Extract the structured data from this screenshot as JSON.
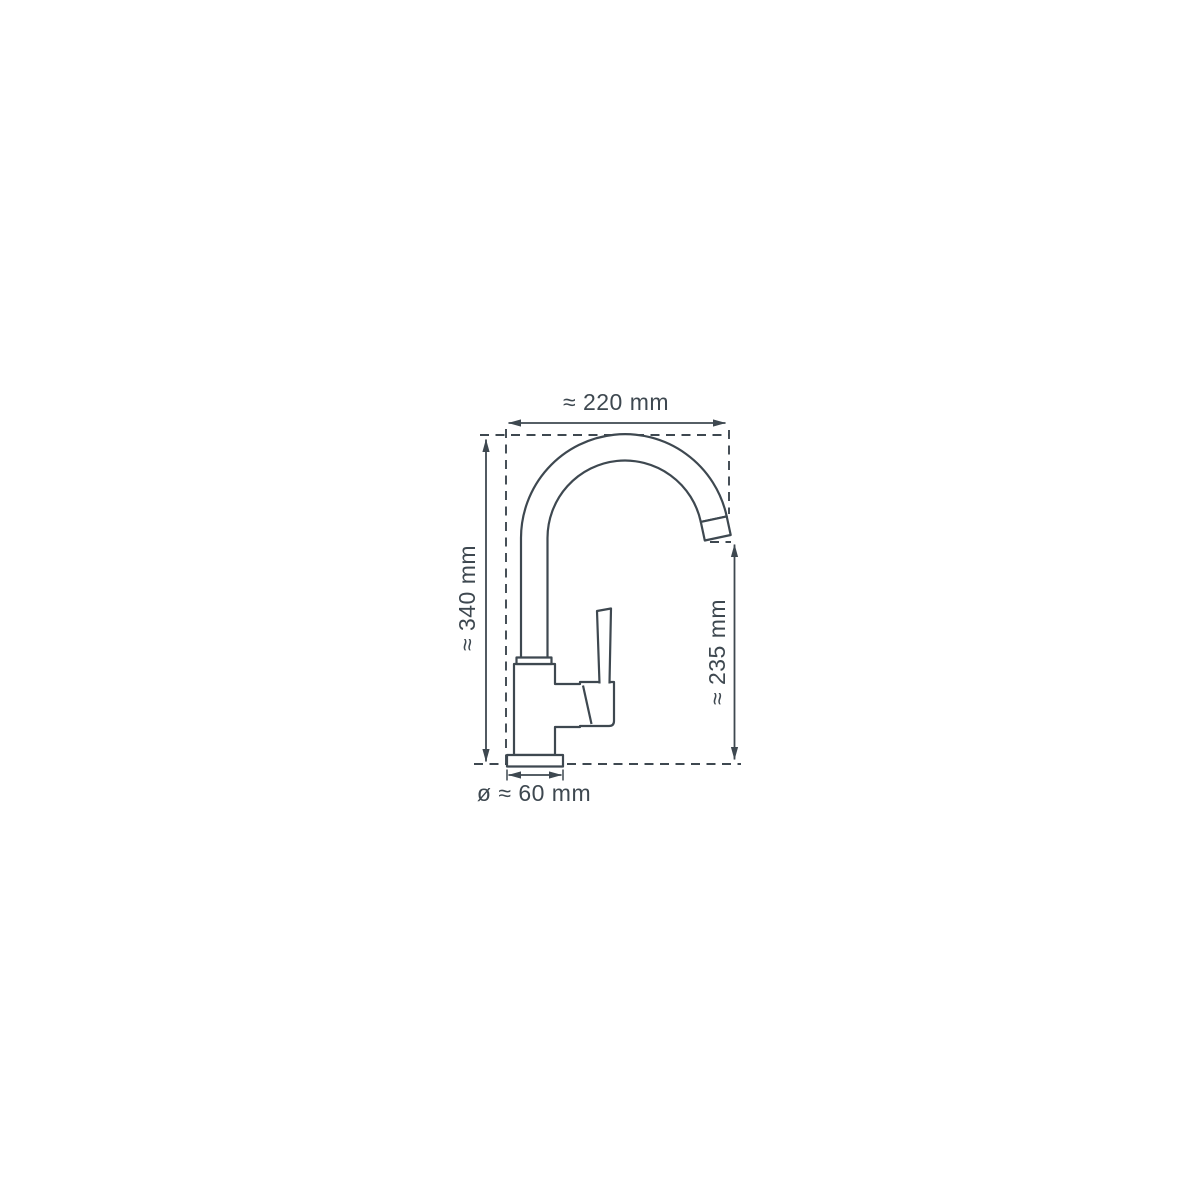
{
  "diagram": {
    "kind": "faucet-technical-dimension-drawing",
    "subject": "single-lever kitchen mixer tap, side view",
    "colors": {
      "line": "#3e4850",
      "background": "#ffffff"
    },
    "dimensions": {
      "spout_width": "≈ 220 mm",
      "total_height": "≈ 340 mm",
      "spout_height": "≈ 235 mm",
      "base_diameter": "ø ≈ 60 mm"
    }
  }
}
